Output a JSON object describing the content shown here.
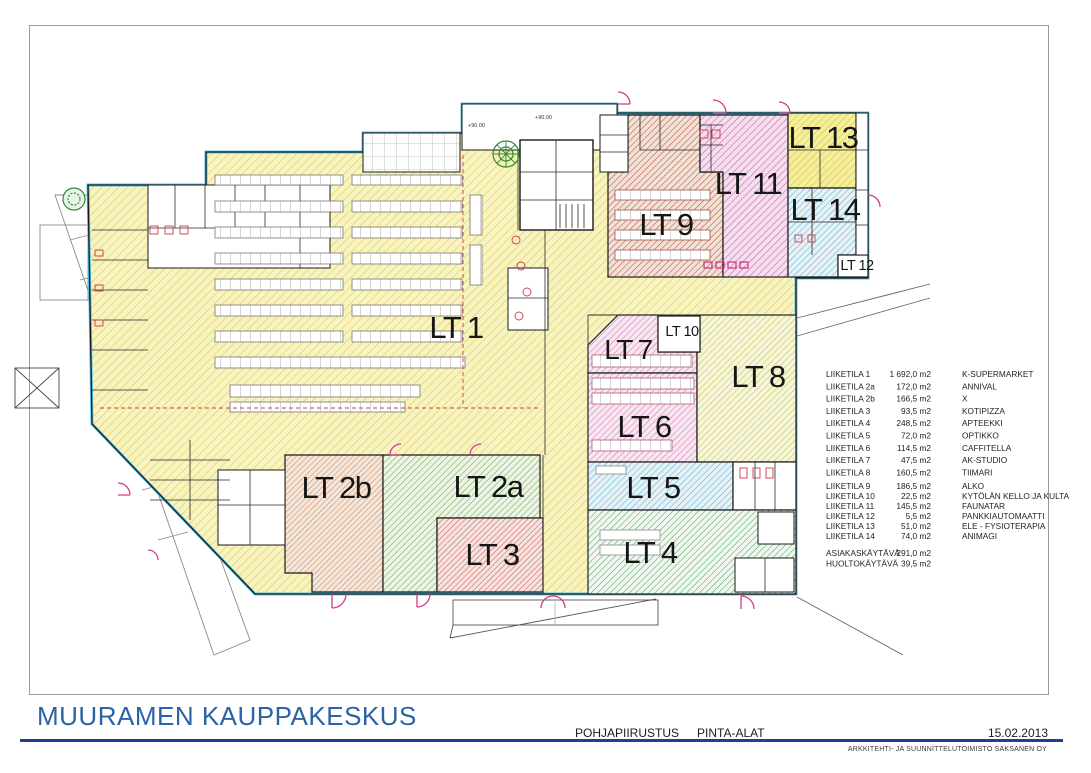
{
  "sheet": {
    "project_title": "MUURAMEN KAUPPAKESKUS",
    "drawing_type": "POHJAPIIRUSTUS",
    "drawing_subtype": "PINTA-ALAT",
    "date": "15.02.2013",
    "firm": "ARKKITEHTI- JA SUUNNITTELUTOIMISTO SAKSANEN OY"
  },
  "rooms": [
    {
      "label": "LT 1"
    },
    {
      "label": "LT 2a"
    },
    {
      "label": "LT 2b"
    },
    {
      "label": "LT 3"
    },
    {
      "label": "LT 4"
    },
    {
      "label": "LT 5"
    },
    {
      "label": "LT 6"
    },
    {
      "label": "LT 7"
    },
    {
      "label": "LT 8"
    },
    {
      "label": "LT 9"
    },
    {
      "label": "LT 10"
    },
    {
      "label": "LT 11"
    },
    {
      "label": "LT 12"
    },
    {
      "label": "LT 13"
    },
    {
      "label": "LT 14"
    }
  ],
  "legend": {
    "rows": [
      {
        "name": "LIIKETILA 1",
        "area": "1 692,0 m2",
        "tenant": "K-SUPERMARKET"
      },
      {
        "name": "LIIKETILA 2a",
        "area": "172,0 m2",
        "tenant": "ANNIVAL"
      },
      {
        "name": "LIIKETILA 2b",
        "area": "166,5 m2",
        "tenant": "X"
      },
      {
        "name": "LIIKETILA 3",
        "area": "93,5 m2",
        "tenant": "KOTIPIZZA"
      },
      {
        "name": "LIIKETILA 4",
        "area": "248,5 m2",
        "tenant": "APTEEKKI"
      },
      {
        "name": "LIIKETILA 5",
        "area": "72,0 m2",
        "tenant": "OPTIKKO"
      },
      {
        "name": "LIIKETILA 6",
        "area": "114,5 m2",
        "tenant": "CAFFITELLA"
      },
      {
        "name": "LIIKETILA 7",
        "area": "47,5 m2",
        "tenant": "AK-STUDIO"
      },
      {
        "name": "LIIKETILA 8",
        "area": "160,5 m2",
        "tenant": "TIIMARI"
      },
      {
        "name": "LIIKETILA 9",
        "area": "186,5 m2",
        "tenant": "ALKO"
      },
      {
        "name": "LIIKETILA 10",
        "area": "22,5 m2",
        "tenant": "KYTÖLÄN KELLO JA KULTA"
      },
      {
        "name": "LIIKETILA 11",
        "area": "145,5 m2",
        "tenant": "FAUNATAR"
      },
      {
        "name": "LIIKETILA 12",
        "area": "5,5 m2",
        "tenant": "PANKKIAUTOMAATTI"
      },
      {
        "name": "LIIKETILA 13",
        "area": "51,0 m2",
        "tenant": "ELE - FYSIOTERAPIA"
      },
      {
        "name": "LIIKETILA 14",
        "area": "74,0 m2",
        "tenant": "ANIMAGI"
      }
    ],
    "totals": [
      {
        "name": "ASIAKASKÄYTÄVÄ",
        "area": "291,0 m2"
      },
      {
        "name": "HUOLTOKÄYTÄVÄ",
        "area": "39,5 m2"
      }
    ]
  },
  "annotations": {
    "elevation": "+90.00"
  },
  "colors": {
    "title_blue": "#2b63a8",
    "rule_navy": "#1f3f94",
    "outline_cyan": "#55c4e6",
    "door_magenta": "#d23b8c",
    "detail_red": "#cc3b49",
    "zones": {
      "lt1_yellow": "#e5d46d",
      "lt2a_green": "#6cab52",
      "lt2b_salmon": "#c1825f",
      "lt3_red": "#c6574c",
      "lt4_green": "#47a057",
      "lt5_blue": "#5fb0cf",
      "lt6_pink": "#cf72ae",
      "lt7_pink": "#cf72ae",
      "lt8_olive": "#c6c35f",
      "lt9_brown": "#ad5a44",
      "lt11_pink": "#c468ac",
      "lt13_yellow": "#d9c93e",
      "lt14_blue": "#5fb0cf"
    }
  }
}
